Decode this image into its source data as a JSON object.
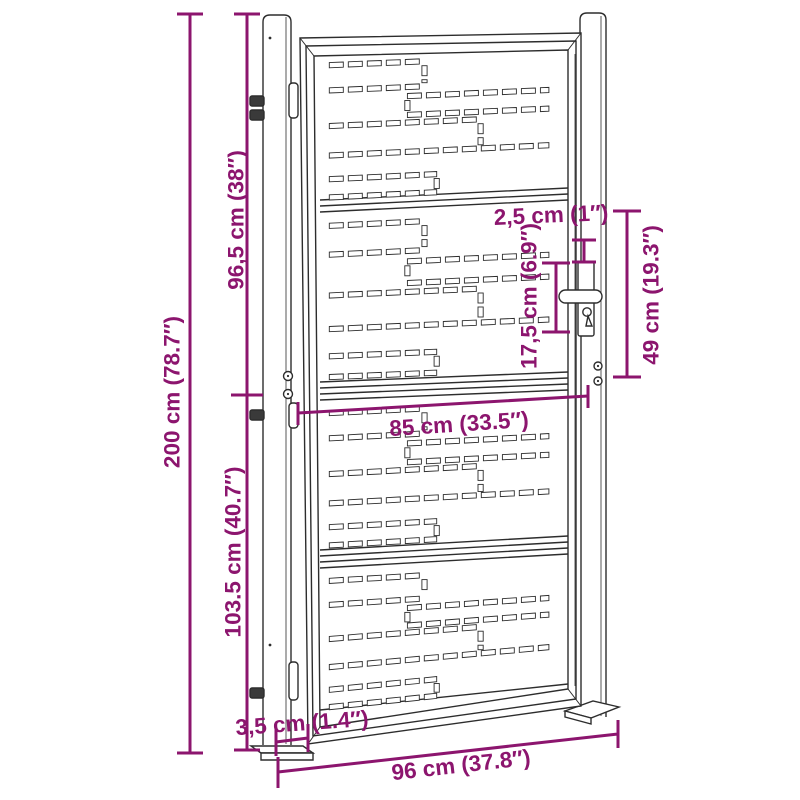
{
  "diagram": {
    "type": "product-dimension-drawing",
    "subject": "garden-gate-with-posts",
    "background_color": "#ffffff",
    "line_color": "#2d2d2d",
    "dimension_color": "#8c156e",
    "dimensions": {
      "total_height": "200 cm (78.7″)",
      "upper_section_height": "96,5 cm (38″)",
      "lower_section_height": "103.5 cm (40.7″)",
      "handle_unit_height": "49 cm (19.3″)",
      "frame_profile": "2,5 cm (1″)",
      "handle_length": "17,5 cm (6.9″)",
      "leaf_width": "85 cm (33.5″)",
      "post_width": "3,5 cm (1.4″)",
      "total_width": "96 cm (37.8″)"
    }
  }
}
